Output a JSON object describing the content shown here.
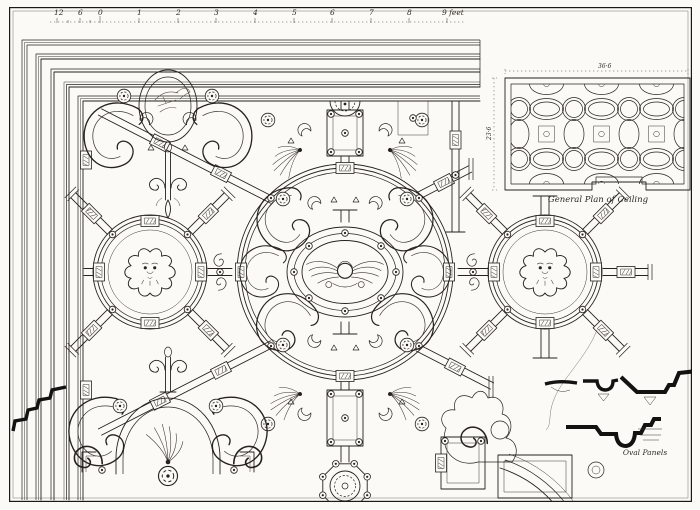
{
  "plate": {
    "description": "Engraved architectural plate: ornamental ceiling plan with scale of feet, small general plan inset, and moulding section profiles",
    "paper_color": "#fbfaf6",
    "ink_color": "#26231e",
    "profile_ink_color": "#141210"
  },
  "scale_bar": {
    "labels": [
      "12",
      "6",
      "0",
      "1",
      "2",
      "3",
      "4",
      "5",
      "6",
      "7",
      "8"
    ],
    "end_label": "9 feet"
  },
  "inset": {
    "caption": "General Plan of Ceiling",
    "width_label": "36·6",
    "height_label": "23·6"
  },
  "profiles": {
    "oval_panels_label": "Oval Panels"
  },
  "motifs": {
    "center": "winged cherub mask in oval cartouche",
    "side_medallions": "lion masks in circular panels",
    "top_left": "helmet trophy in oval",
    "bottom_left": "arched cartouche with flame ornament"
  }
}
